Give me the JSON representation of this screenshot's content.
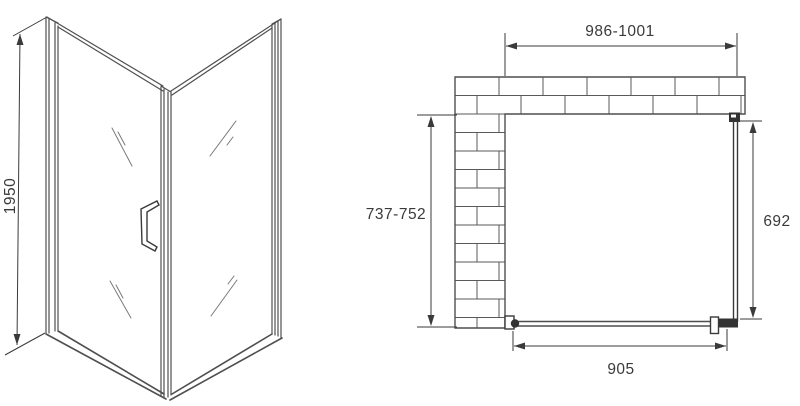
{
  "dims": {
    "height": {
      "label": "1950"
    },
    "opening_width": {
      "label": "986-1001"
    },
    "depth": {
      "label": "737-752"
    },
    "side_panel": {
      "label": "692"
    },
    "door_bottom": {
      "label": "905"
    }
  },
  "colors": {
    "background": "#ffffff",
    "line": "#4f4f4f",
    "dim_line": "#3a3a3a",
    "text": "#3a3a3a",
    "fill_dark": "#333333",
    "brick_line": "#5a5a5a",
    "shine": "#7a7a7a"
  }
}
